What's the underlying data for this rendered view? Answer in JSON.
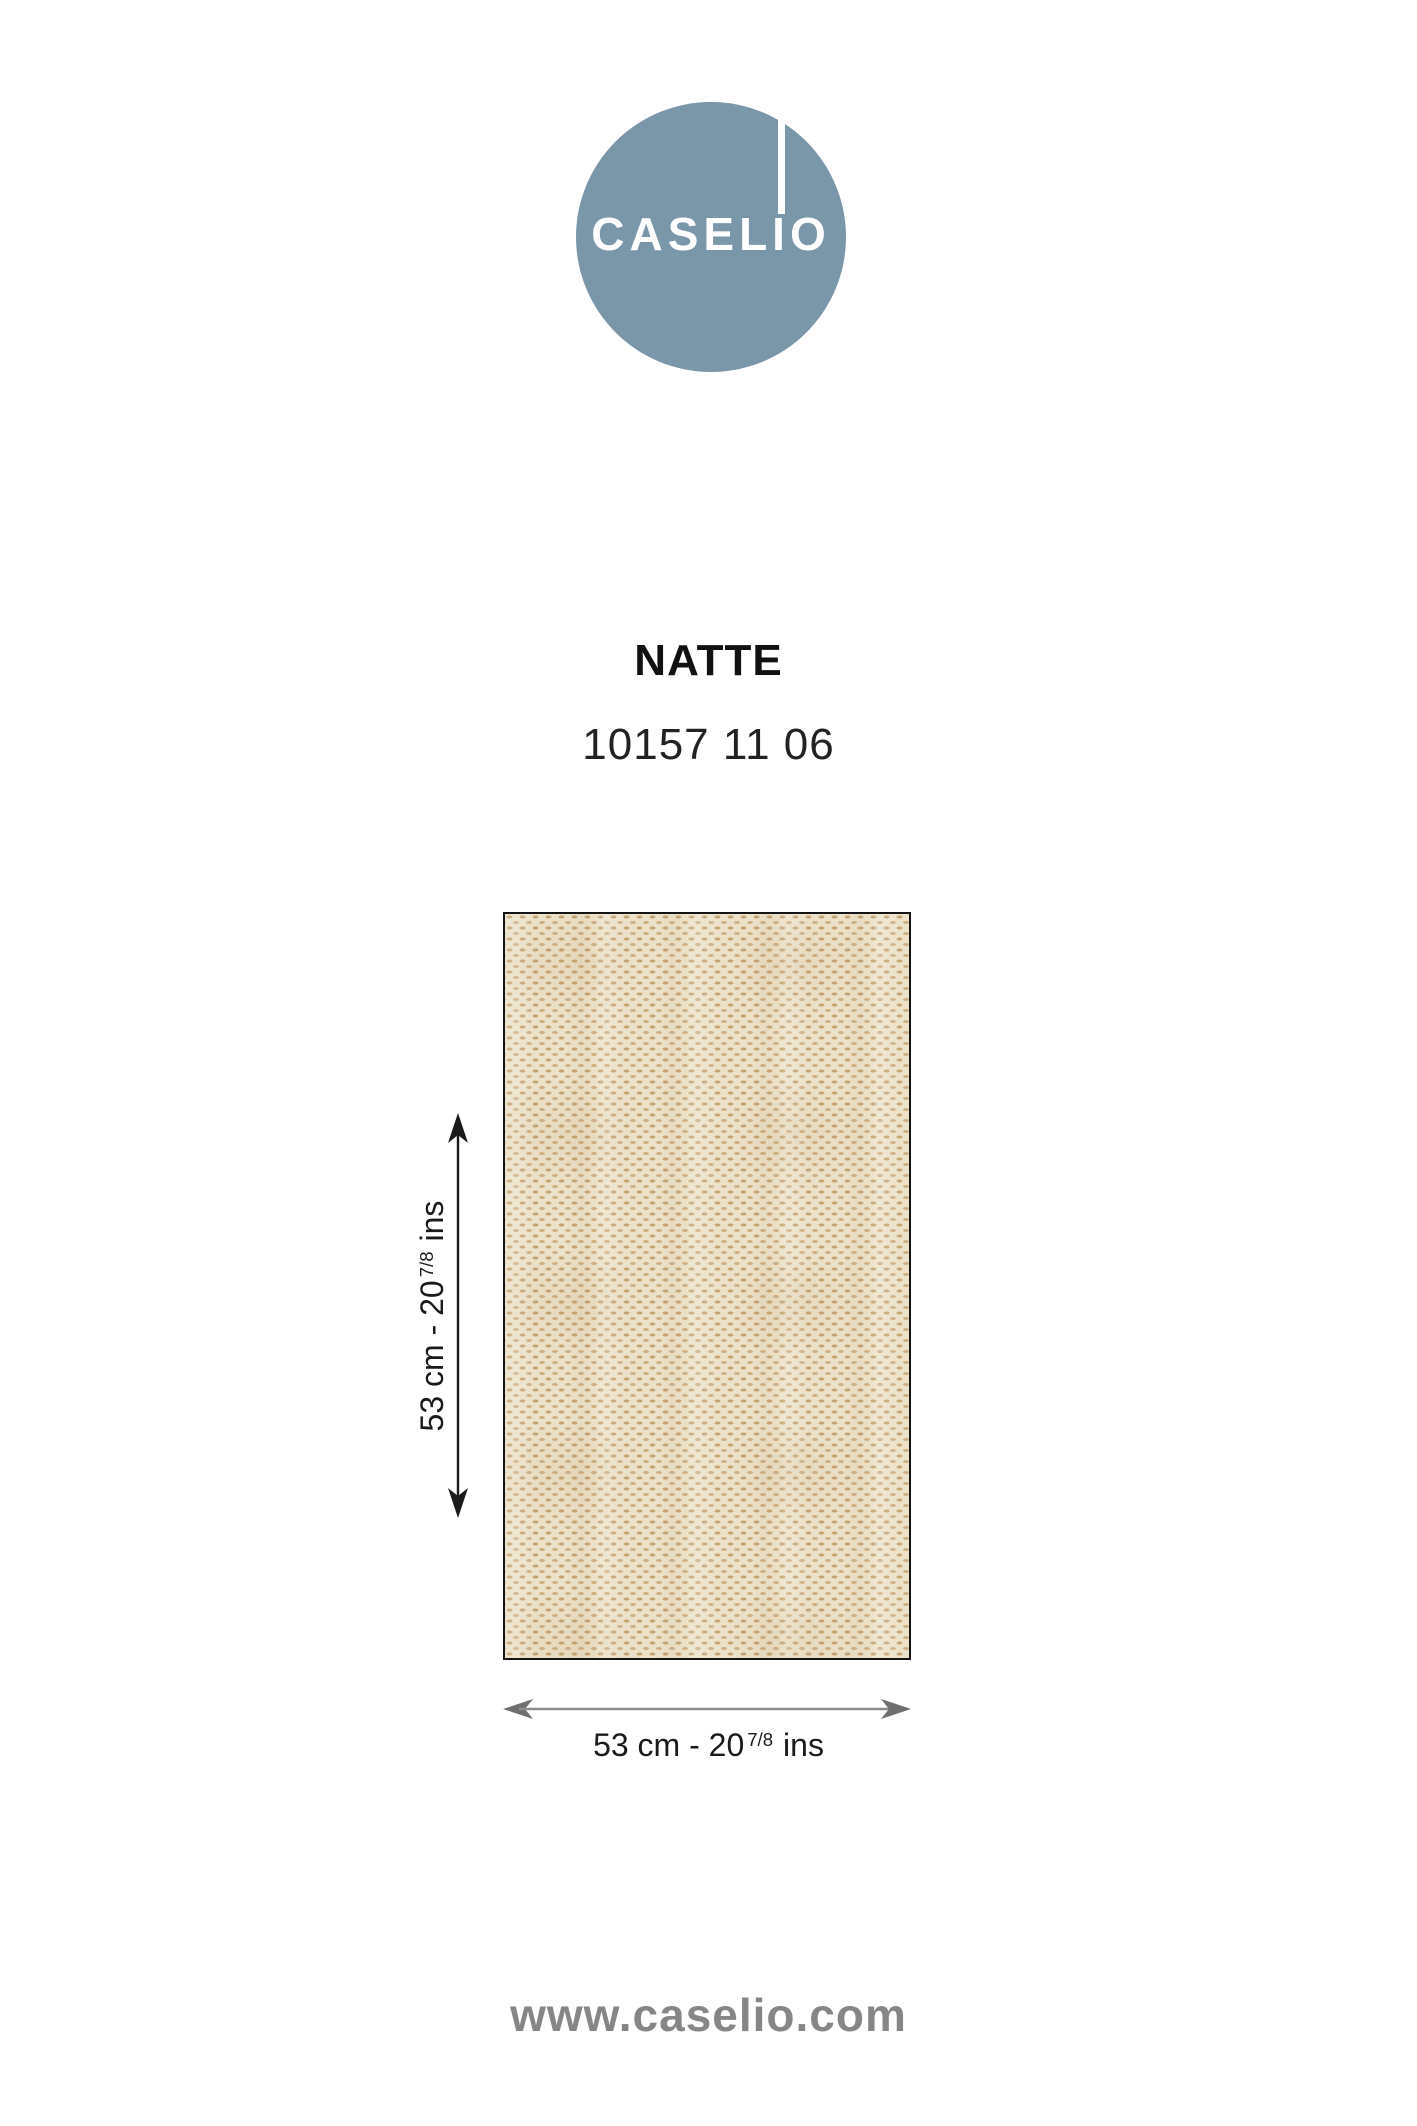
{
  "brand": {
    "logo_full": "CASELIO",
    "logo_text_left": "CASEL",
    "logo_text_i": "I",
    "logo_text_right": "O",
    "circle_color": "#7A96A9",
    "wordmark_color": "#FFFFFF"
  },
  "product": {
    "name": "NATTE",
    "reference": "10157 11 06"
  },
  "swatch": {
    "background_color": "#ECE2C9",
    "weave_color": "#C6A373",
    "weave_color_light": "#CFB085",
    "border_color": "#141414"
  },
  "dimensions": {
    "height": {
      "main": "53 cm - 20",
      "sup": "7/8",
      "unit": "ins"
    },
    "width": {
      "main": "53 cm - 20",
      "sup": "7/8",
      "unit": "ins"
    },
    "height_arrow_color": "#1A1A1A",
    "width_arrow_color": "#7B7B7B"
  },
  "footer": {
    "website": "www.caselio.com",
    "color": "#868686"
  }
}
